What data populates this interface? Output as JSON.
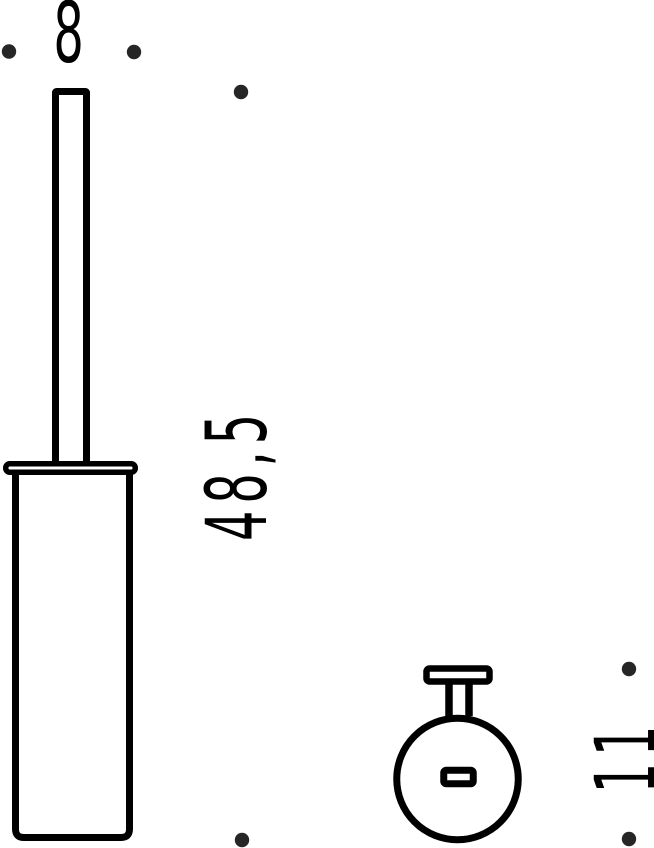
{
  "page": {
    "background_color": "#ffffff",
    "drawing": {
      "kind": "technical-dimension-drawing",
      "subject": "toilet-brush-holder",
      "line_color": "#000000",
      "dot_color": "#262626",
      "views": {
        "side_view": "brush-with-canister-front-view",
        "top_view": "wall-mount-top-view"
      },
      "dimension_labels": {
        "width": "8",
        "height": "48,5",
        "depth": "11"
      }
    }
  }
}
